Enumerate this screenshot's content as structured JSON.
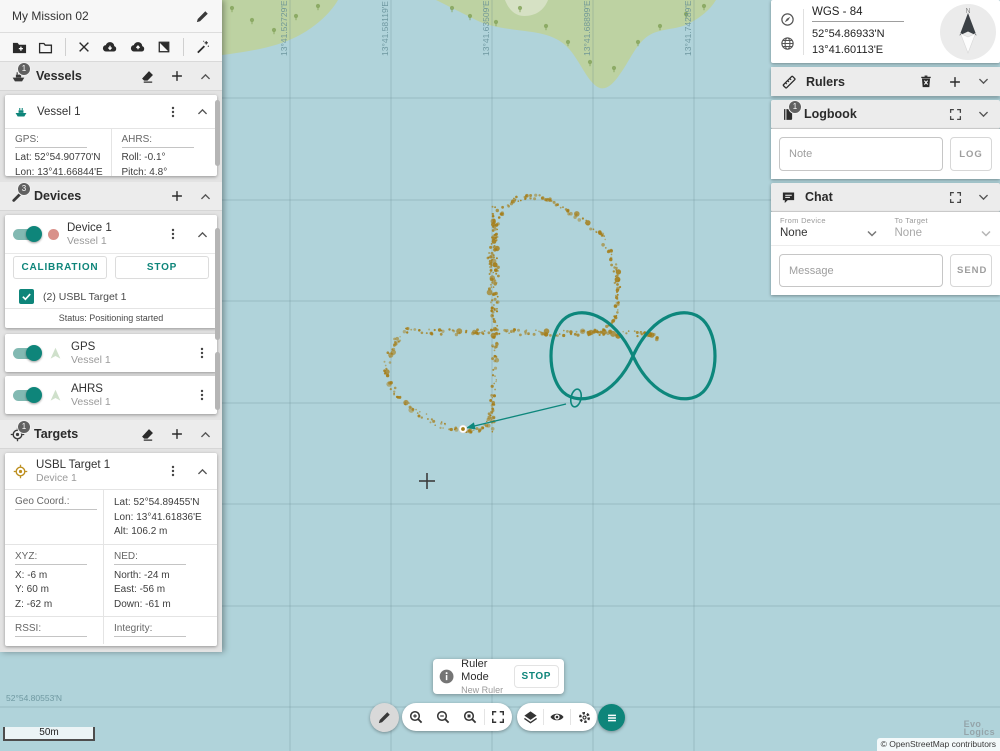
{
  "mission": {
    "title": "My Mission 02"
  },
  "vessels": {
    "badge": "1",
    "title": "Vessels",
    "vessel": {
      "name": "Vessel 1",
      "gps_label": "GPS:",
      "gps_lat": "Lat: 52°54.90770'N",
      "gps_lon": "Lon: 13°41.66844'E",
      "gps_alt": "Alt: 45.9 m",
      "ahrs_label": "AHRS:",
      "ahrs_roll": "Roll: -0.1°",
      "ahrs_pitch": "Pitch: 4.8°",
      "ahrs_heading": "Heading: 146.3°"
    }
  },
  "devices": {
    "badge": "3",
    "title": "Devices",
    "device1": {
      "name": "Device 1",
      "vessel": "Vessel 1",
      "calibration_label": "CALIBRATION",
      "stop_label": "STOP",
      "target_checkbox": "(2) USBL Target 1",
      "status": "Status: Positioning started"
    },
    "gps": {
      "name": "GPS",
      "vessel": "Vessel 1"
    },
    "ahrs": {
      "name": "AHRS",
      "vessel": "Vessel 1"
    }
  },
  "targets": {
    "badge": "1",
    "title": "Targets",
    "target": {
      "name": "USBL Target 1",
      "device": "Device 1",
      "geo_label": "Geo Coord.:",
      "geo_lat": "Lat: 52°54.89455'N",
      "geo_lon": "Lon: 13°41.61836'E",
      "geo_alt": "Alt: 106.2 m",
      "xyz_label": "XYZ:",
      "xyz": [
        "X: -6 m",
        "Y: 60 m",
        "Z: -62 m"
      ],
      "ned_label": "NED:",
      "ned": [
        "North: -24 m",
        "East: -56 m",
        "Down: -61 m"
      ],
      "rssi_label": "RSSI:",
      "integrity_label": "Integrity:"
    }
  },
  "right": {
    "coords": {
      "datum": "WGS - 84",
      "lat": "52°54.86933'N",
      "lon": "13°41.60113'E",
      "compass_n": "N"
    },
    "rulers": {
      "title": "Rulers"
    },
    "logbook": {
      "badge": "1",
      "title": "Logbook",
      "note_placeholder": "Note",
      "log_label": "LOG"
    },
    "chat": {
      "title": "Chat",
      "from_label": "From Device",
      "from_value": "None",
      "to_label": "To Target",
      "to_value": "None",
      "message_placeholder": "Message",
      "send_label": "SEND"
    }
  },
  "controls": {
    "toast_title": "Ruler Mode",
    "toast_subtitle": "New Ruler",
    "toast_stop": "STOP",
    "scale_label": "50m",
    "attribution": "© OpenStreetMap contributors",
    "logo_top": "Evo",
    "logo_bottom": "Logics"
  },
  "map": {
    "water_color": "#b0d3da",
    "land_color": "#bdd2a2",
    "land_light_color": "#d6e1c4",
    "grid_color": "rgba(90,125,135,0.28)",
    "label_color": "#5f8a93",
    "accent_color": "#0e857a",
    "path_color": "#0d877c",
    "dot_color": "#a57d18",
    "tree_color": "#85a45c",
    "grid_x": [
      290,
      391,
      492,
      593,
      694
    ],
    "grid_y": [
      98,
      200,
      301,
      403,
      504,
      606,
      707
    ],
    "lon_labels": [
      "13°41.52729'E",
      "13°41.58119'E",
      "13°41.63509'E",
      "13°41.68899'E",
      "13°41.74289'E"
    ],
    "lat_label": "52°54.80553'N",
    "land_paths": [
      "M196,0 L338,0 C330,14 314,28 296,37 C274,48 244,53 196,58 Z",
      "M436,0 L716,0 C710,10 700,18 688,24 C676,30 660,28 648,36 C636,44 630,60 620,74 C612,86 604,92 596,86 C586,78 580,62 570,50 C560,38 546,34 532,32 C512,29 492,28 476,20 C462,13 448,6 436,0 Z"
    ],
    "land_patch": "M505,0 L548,0 C544,10 536,16 524,16 C514,16 508,8 505,0 Z",
    "trees": [
      [
        232,
        8
      ],
      [
        252,
        20
      ],
      [
        274,
        30
      ],
      [
        296,
        16
      ],
      [
        318,
        6
      ],
      [
        452,
        8
      ],
      [
        470,
        16
      ],
      [
        496,
        22
      ],
      [
        520,
        8
      ],
      [
        546,
        26
      ],
      [
        568,
        42
      ],
      [
        590,
        62
      ],
      [
        614,
        68
      ],
      [
        638,
        42
      ],
      [
        660,
        26
      ],
      [
        686,
        14
      ],
      [
        704,
        6
      ]
    ],
    "dotted_segments": [
      [
        [
          497,
          332
        ],
        [
          493,
          310
        ],
        [
          490,
          285
        ],
        [
          490,
          258
        ],
        [
          494,
          232
        ],
        [
          502,
          212
        ],
        [
          514,
          200
        ],
        [
          530,
          196
        ],
        [
          548,
          199
        ],
        [
          566,
          210
        ],
        [
          584,
          220
        ],
        [
          600,
          235
        ],
        [
          611,
          252
        ],
        [
          616,
          270
        ],
        [
          618,
          290
        ],
        [
          617,
          308
        ],
        [
          612,
          322
        ],
        [
          602,
          330
        ],
        [
          590,
          333
        ]
      ],
      [
        [
          408,
          331
        ],
        [
          440,
          332
        ],
        [
          475,
          332
        ],
        [
          510,
          332
        ],
        [
          545,
          333
        ],
        [
          580,
          333
        ],
        [
          612,
          333
        ],
        [
          640,
          334
        ],
        [
          656,
          337
        ]
      ],
      [
        [
          495,
          205
        ],
        [
          495,
          240
        ],
        [
          496,
          275
        ],
        [
          495,
          310
        ],
        [
          495,
          345
        ],
        [
          494,
          380
        ],
        [
          493,
          402
        ],
        [
          492,
          420
        ],
        [
          490,
          431
        ]
      ],
      [
        [
          408,
          331
        ],
        [
          397,
          341
        ],
        [
          389,
          354
        ],
        [
          386,
          367
        ],
        [
          389,
          381
        ],
        [
          396,
          393
        ],
        [
          406,
          403
        ],
        [
          418,
          412
        ],
        [
          430,
          420
        ],
        [
          443,
          426
        ],
        [
          456,
          430
        ],
        [
          468,
          432
        ],
        [
          479,
          430
        ],
        [
          487,
          424
        ],
        [
          491,
          414
        ],
        [
          493,
          400
        ]
      ]
    ],
    "infinity_path": "M633,356 C614,314 580,304 563,320 C547,336 547,376 563,392 C579,407 614,398 633,356 C652,314 686,304 703,320 C719,336 719,376 703,392 C687,407 652,398 633,356",
    "small_loop": {
      "cx": 576,
      "cy": 398,
      "rx": 5,
      "ry": 9,
      "rot": 12
    },
    "arrow": {
      "x1": 566,
      "y1": 404,
      "x2": 466,
      "y2": 428
    },
    "target_point": {
      "x": 463,
      "y": 429
    },
    "crosshair": {
      "x": 427,
      "y": 481,
      "color": "#3c3c3c"
    }
  }
}
